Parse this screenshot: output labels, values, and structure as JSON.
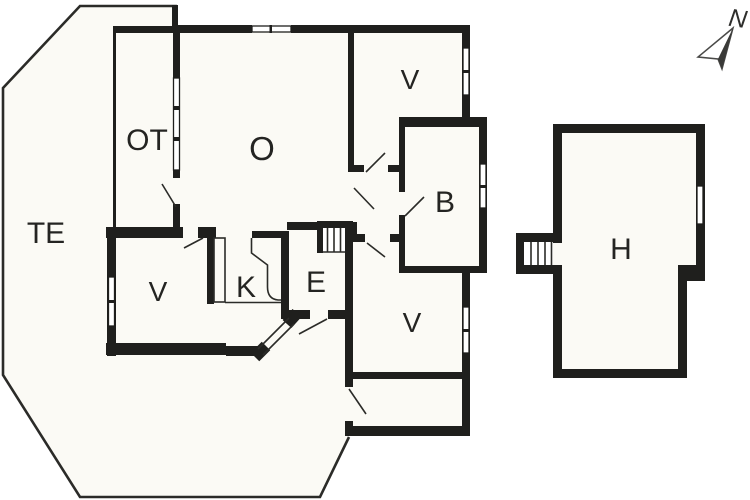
{
  "title": "Floor plan",
  "colors": {
    "wall": "#1f1f1d",
    "floor": "#fbfaf5",
    "background": "#ffffff",
    "line": "#2b2b28"
  },
  "rooms": [
    {
      "id": "te",
      "label": "TE"
    },
    {
      "id": "ot",
      "label": "OT"
    },
    {
      "id": "o",
      "label": "O"
    },
    {
      "id": "v-north",
      "label": "V"
    },
    {
      "id": "b",
      "label": "B"
    },
    {
      "id": "v-west",
      "label": "V"
    },
    {
      "id": "k",
      "label": "K"
    },
    {
      "id": "e",
      "label": "E"
    },
    {
      "id": "v-south",
      "label": "V"
    },
    {
      "id": "h",
      "label": "H"
    }
  ],
  "compass": {
    "label": "N"
  }
}
